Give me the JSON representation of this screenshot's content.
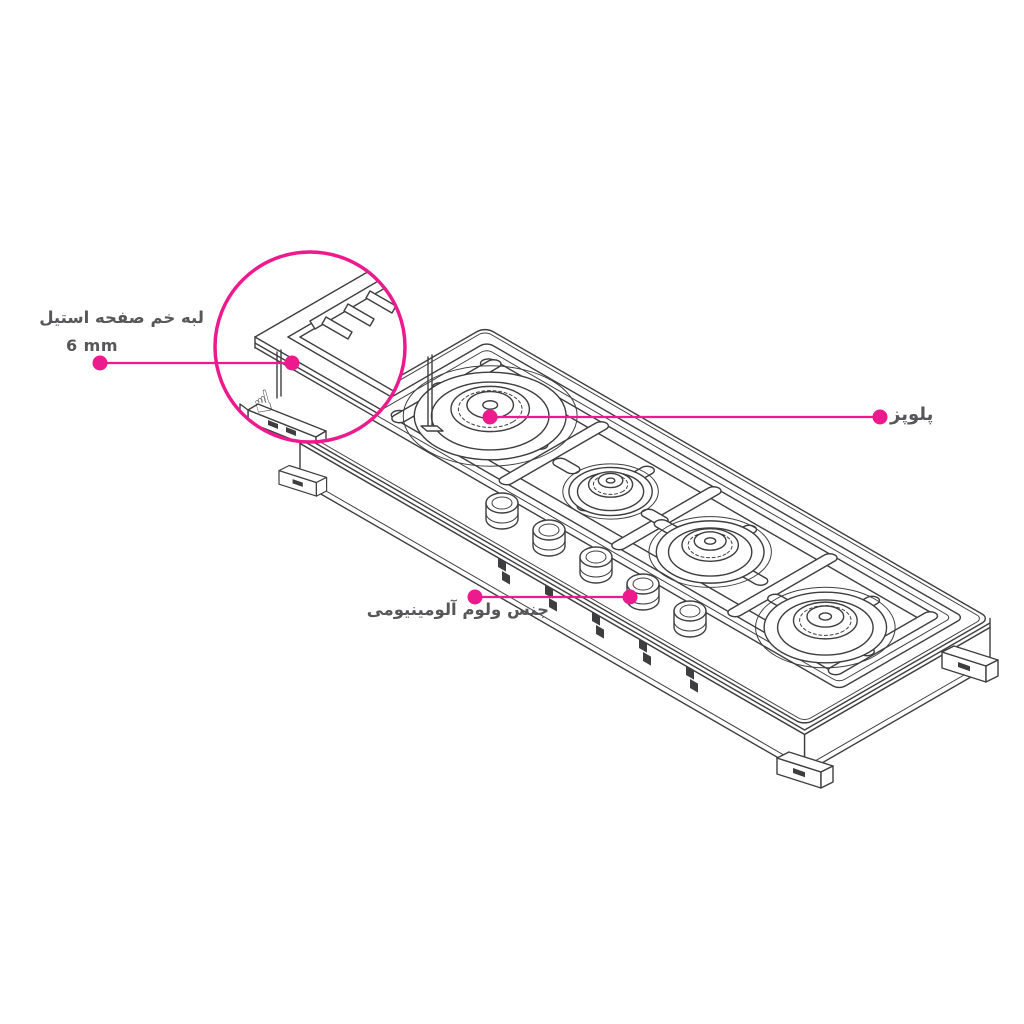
{
  "colors": {
    "accent": "#EC1A8C",
    "line": "#3E3E40",
    "text": "#57575A",
    "background": "#FFFFFF"
  },
  "annotations": {
    "edge": {
      "label": "لبه خم صفحه استیل",
      "value": "6 mm"
    },
    "burner": {
      "label": "پلوپز"
    },
    "knob": {
      "label": "جنس ولوم آلومینیومی"
    }
  }
}
